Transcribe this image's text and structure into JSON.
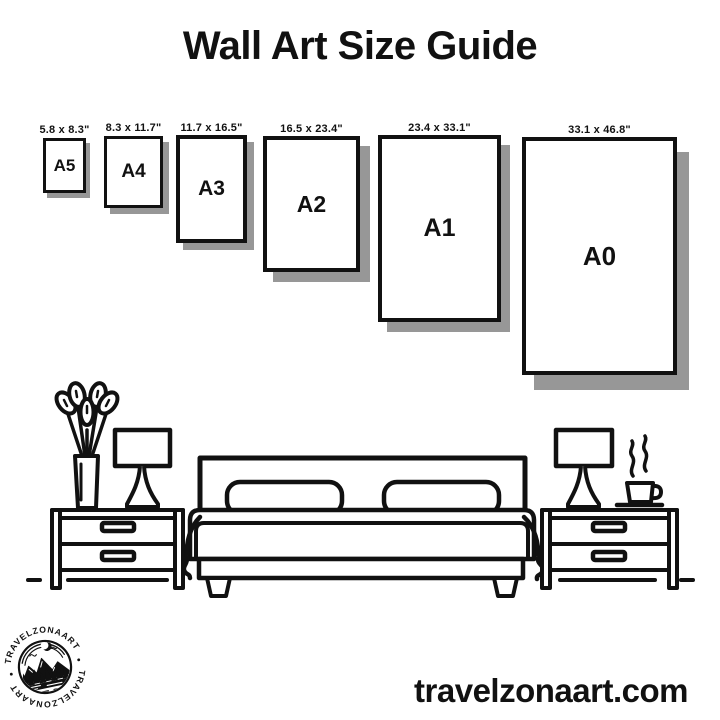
{
  "title": "Wall Art Size Guide",
  "sizes": [
    {
      "code": "A5",
      "dimensions": "5.8 x 8.3\""
    },
    {
      "code": "A4",
      "dimensions": "8.3 x 11.7\""
    },
    {
      "code": "A3",
      "dimensions": "11.7 x 16.5\""
    },
    {
      "code": "A2",
      "dimensions": "16.5 x 23.4\""
    },
    {
      "code": "A1",
      "dimensions": "23.4 x 33.1\""
    },
    {
      "code": "A0",
      "dimensions": "33.1 x 46.8\""
    }
  ],
  "logo": {
    "top_text": "TRAVELZONAART",
    "bottom_text": "TRAVELZONAART"
  },
  "footer": {
    "website": "travelzonaart.com"
  },
  "illustration": {
    "description": "black line-art bedroom scene: double bed with two pillows, two nightstands with drawers, table lamps, vase with plant, steaming coffee cup"
  },
  "colors": {
    "ink": "#111111",
    "shadow": "#979797",
    "background": "#ffffff"
  }
}
